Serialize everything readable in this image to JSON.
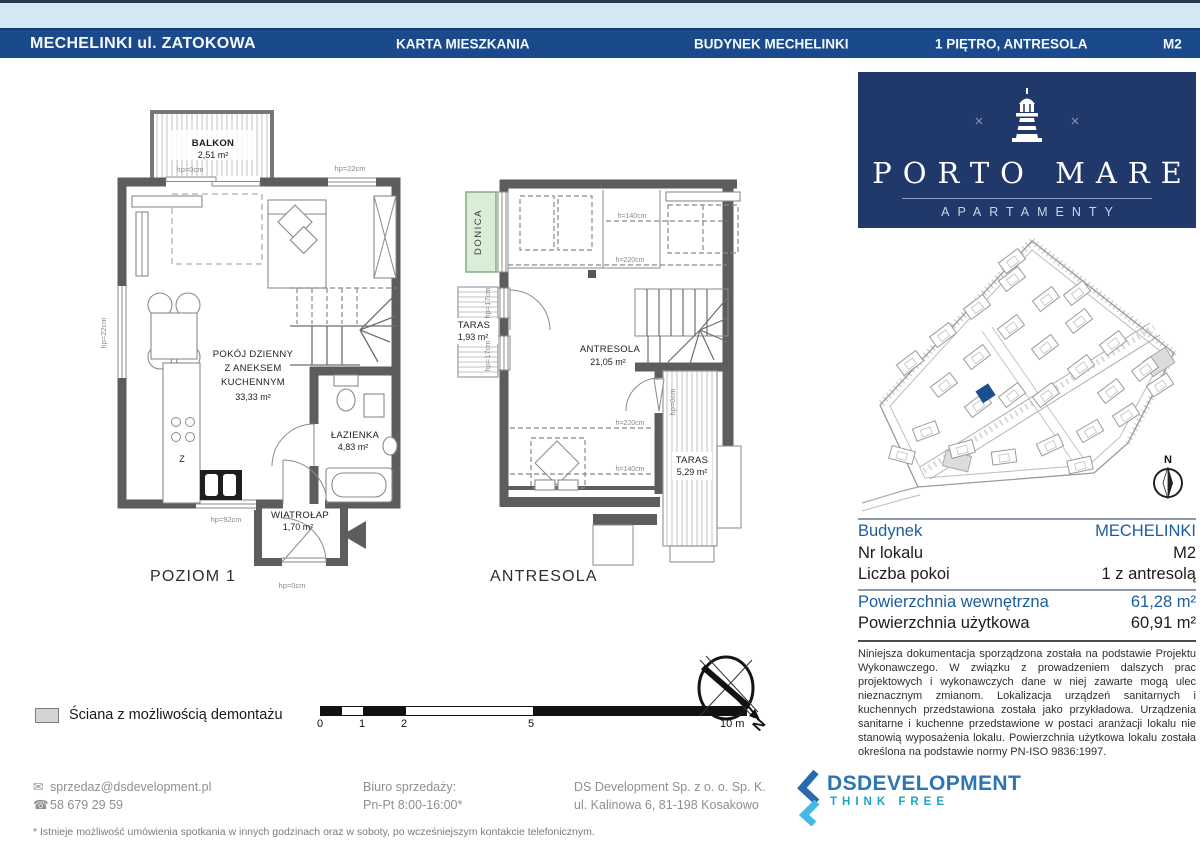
{
  "header": {
    "project": "MECHELINKI ul. ZATOKOWA",
    "doc_type": "KARTA MIESZKANIA",
    "building": "BUDYNEK MECHELINKI",
    "floor": "1 PIĘTRO, ANTRESOLA",
    "unit": "M2"
  },
  "plans": {
    "dims": {
      "hp0": "hp=0cm",
      "hp17": "hp=17cm",
      "hp22": "hp=22cm",
      "hp92": "hp=92cm",
      "h140": "h=140cm",
      "h220": "h=220cm"
    },
    "poziom1": {
      "title": "POZIOM 1",
      "balkon": "BALKON",
      "balkon_area": "2,51 m²",
      "pokoj1": "POKÓJ DZIENNY",
      "pokoj2": "Z ANEKSEM",
      "pokoj3": "KUCHENNYM",
      "pokoj_area": "33,33 m²",
      "lazienka": "ŁAZIENKA",
      "lazienka_area": "4,83 m²",
      "wiatrolap": "WIATROŁAP",
      "wiatrolap_area": "1,70 m²",
      "kitchen_mark": "Z"
    },
    "antresola": {
      "title": "ANTRESOLA",
      "donica": "DONICA",
      "taras1": "TARAS",
      "taras1_area": "1,93 m²",
      "room": "ANTRESOLA",
      "room_area": "21,05 m²",
      "taras2": "TARAS",
      "taras2_area": "5,29 m²"
    }
  },
  "branding": {
    "name": "PORTO MARE",
    "subtitle": "APARTAMENTY"
  },
  "map": {
    "n": "N"
  },
  "details": {
    "rows": [
      {
        "label": "Budynek",
        "value": "MECHELINKI"
      },
      {
        "label": "Nr lokalu",
        "value": "M2"
      },
      {
        "label": "Liczba pokoi",
        "value": "1 z antresolą"
      }
    ],
    "area_rows": [
      {
        "label": "Powierzchnia wewnętrzna",
        "value": "61,28 m²"
      },
      {
        "label": "Powierzchnia użytkowa",
        "value": "60,91 m²"
      }
    ]
  },
  "disclaimer": "Niniejsza dokumentacja sporządzona została na podstawie Projektu Wykonawczego. W związku z prowadzeniem dalszych prac projektowych i wykonawczych dane w niej zawarte mogą ulec nieznacznym zmianom. Lokalizacja urządzeń sanitarnych i kuchennych przedstawiona została jako przykładowa. Urządzenia sanitarne i kuchenne przedstawione w postaci aranżacji lokalu nie stanowią wyposażenia lokalu. Powierzchnia użytkowa lokalu została określona na podstawie normy PN-ISO 9836:1997.",
  "legend": {
    "wall_label": "Ściana z możliwością demontażu"
  },
  "scalebar": {
    "ticks": [
      "0",
      "1",
      "2",
      "5"
    ],
    "end": "10 m"
  },
  "compass": {
    "n": "N"
  },
  "footer": {
    "email": "sprzedaz@dsdevelopment.pl",
    "phone": "58 679 29 59",
    "office_label": "Biuro sprzedaży:",
    "office_hours": "Pn-Pt 8:00-16:00*",
    "company": "DS Development Sp. z o. o. Sp. K.",
    "address": "ul. Kalinowa 6, 81-198 Kosakowo",
    "logo_text": "DSDEVELOPMENT",
    "logo_tagline": "THINK FREE",
    "note": "* Istnieje możliwość umówienia spotkania w innych godzinach oraz w soboty, po wcześniejszym kontakcie telefonicznym."
  }
}
